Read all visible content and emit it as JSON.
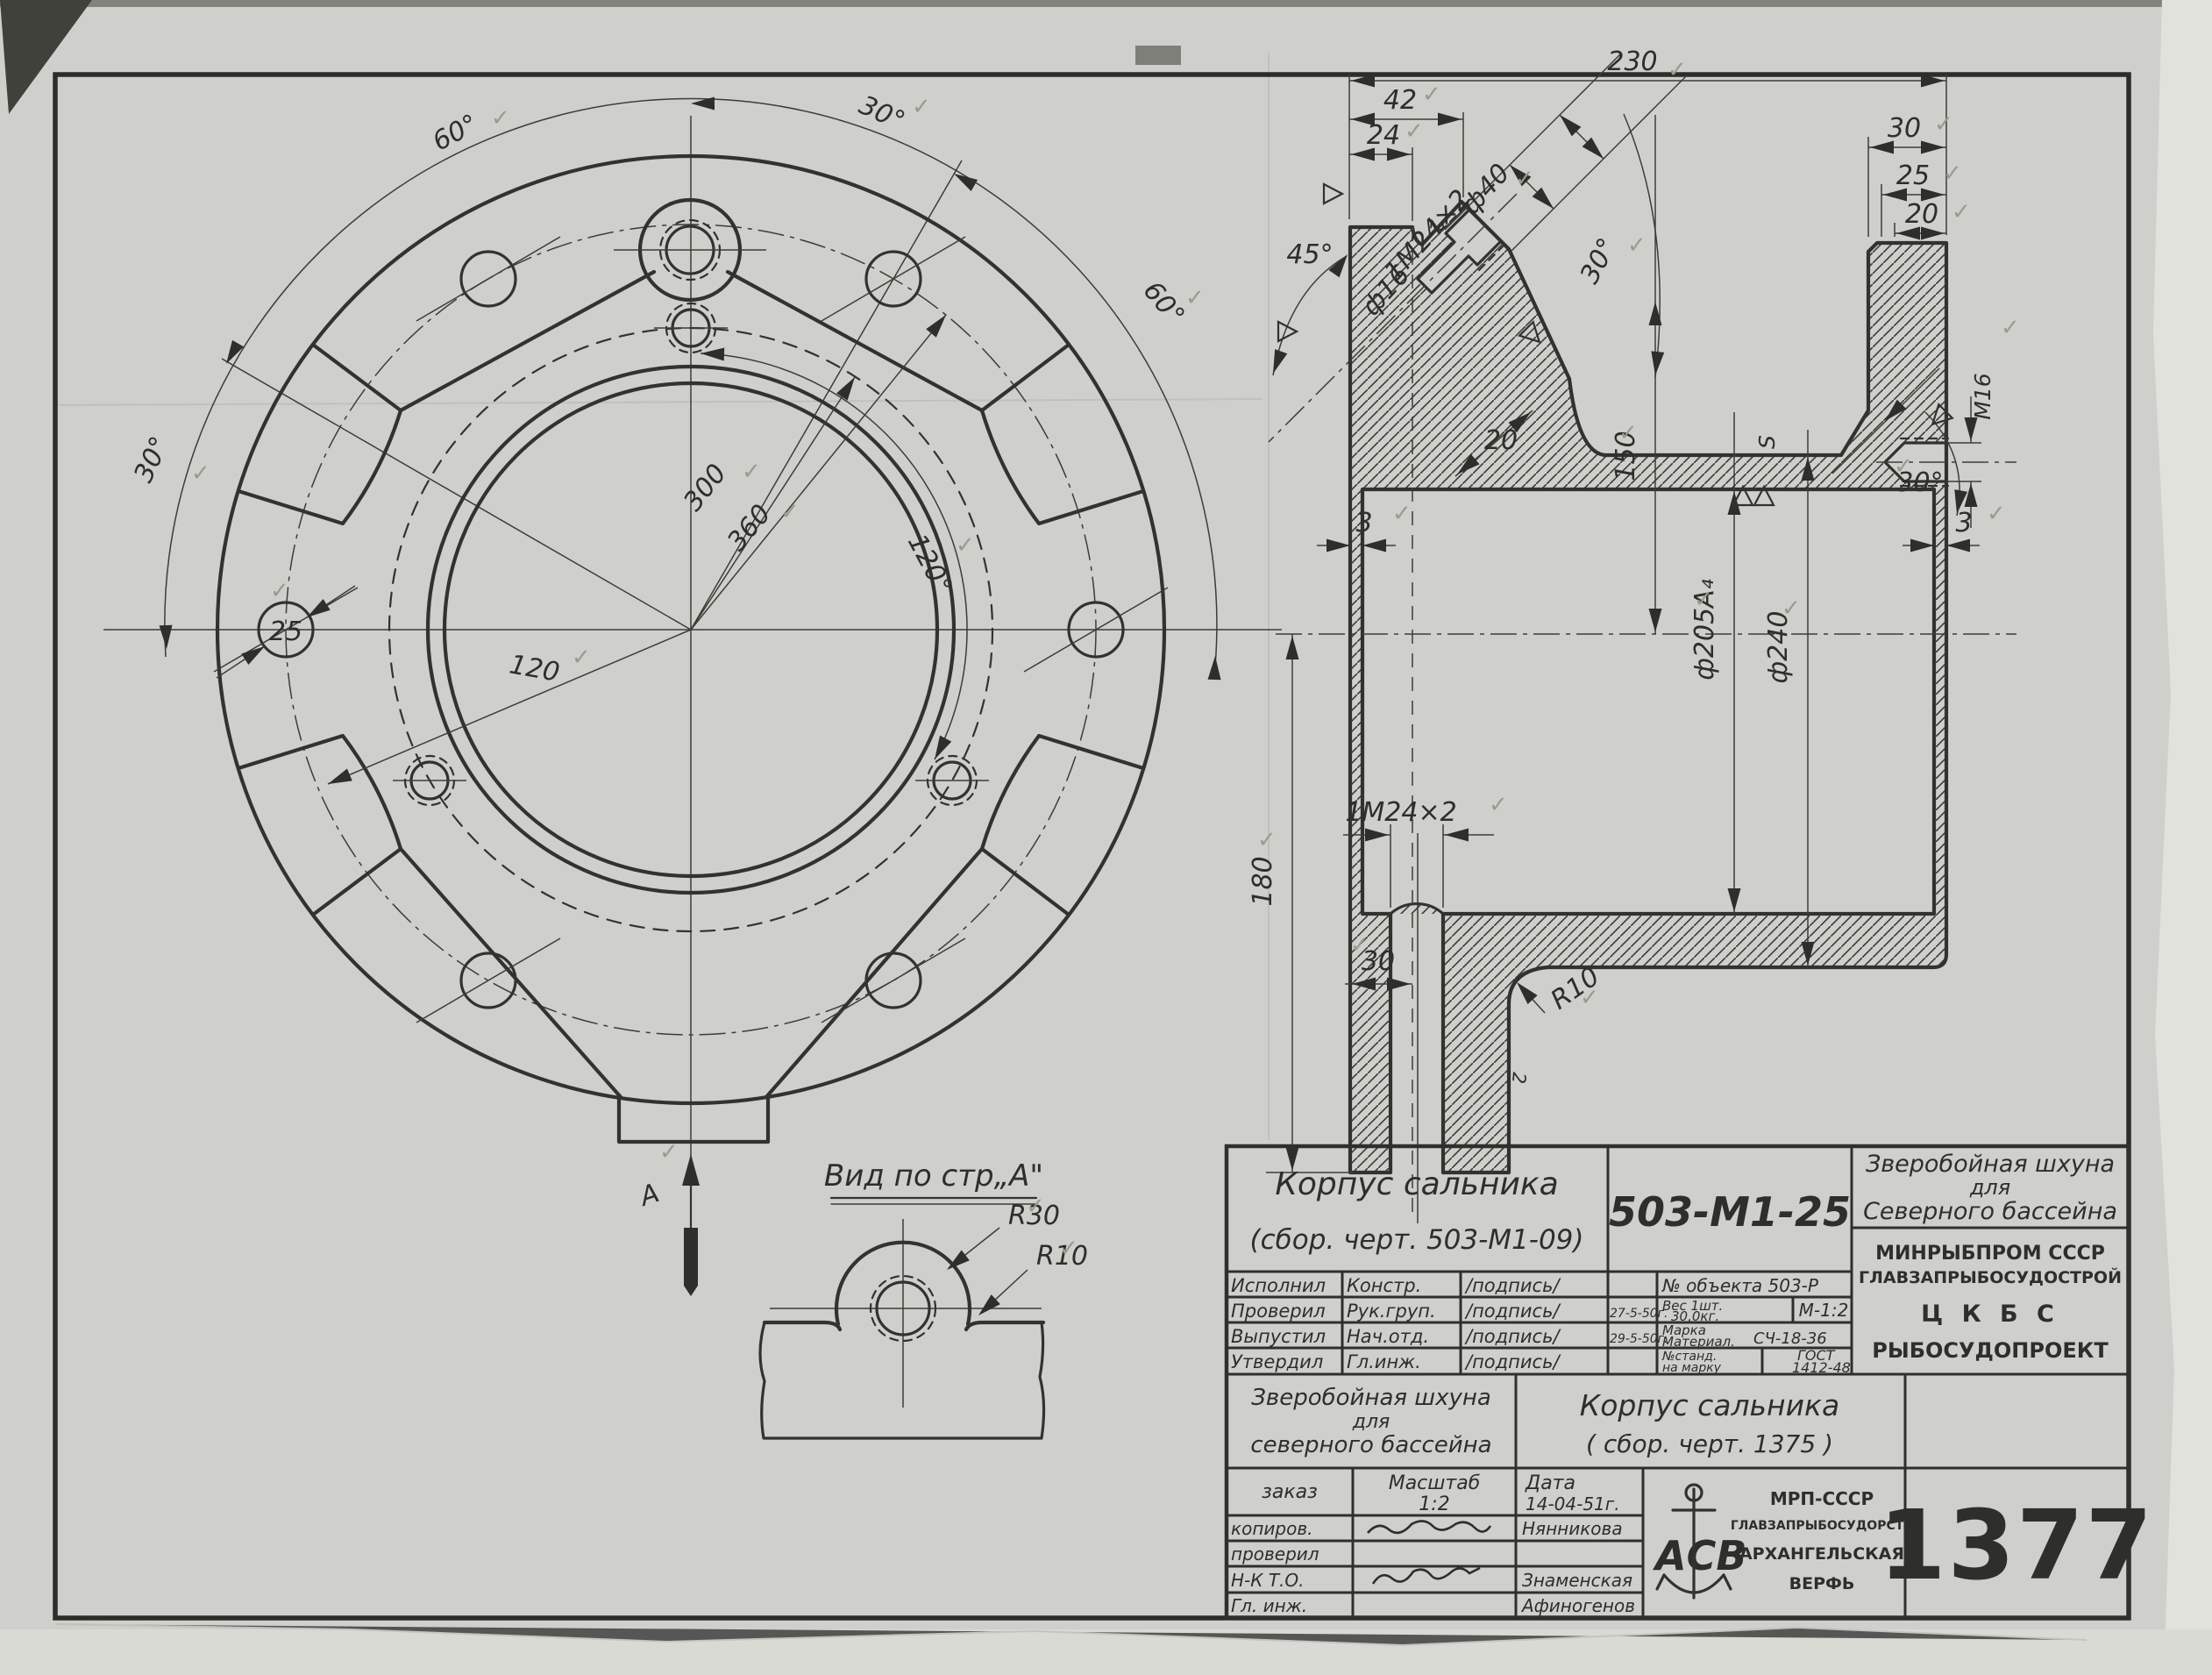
{
  "front_view": {
    "angle_top_left": "60°",
    "angle_top": "30°",
    "angle_right": "60°",
    "angle_left": "30°",
    "angle_bolt": "120°",
    "dim_bore": "300",
    "dim_bolt_circle": "360",
    "dim_left": "120",
    "hole_dia": "25",
    "view_arrow_label": "А"
  },
  "detail_view": {
    "title": "Вид по стр„А\"",
    "r_outer": "R30",
    "r_fillet": "R10"
  },
  "section_view": {
    "d230": "230",
    "d42": "42",
    "d24": "24",
    "r2_top": "2",
    "a45": "45°",
    "dia16": "ф16",
    "thr45": "1М24×2",
    "dia40": "ф40",
    "a30_top": "30°",
    "d20_slope": "20",
    "d30_right": "30",
    "d25_right": "25",
    "d20_right": "20",
    "m16": "М16",
    "a30_right": "30°",
    "w3_left": "3",
    "w3_right": "3",
    "d150": "150",
    "dia205": "ф205А₄",
    "dia240": "ф240",
    "s_mark": "S",
    "d180": "180",
    "thr_bottom": "1М24×2",
    "d30_bottom": "30",
    "r10": "R10",
    "r2_bottom": "2"
  },
  "title_block": {
    "part_title": "Корпус сальника",
    "part_subtitle": "(сбор. черт. 503-М1-09)",
    "doc_number": "503-М1-25",
    "ship1": "Зверобойная шхуна",
    "ship2": "для",
    "ship3": "Северного бассейна",
    "org1": "МИНРЫБПРОМ СССР",
    "org2": "ГЛАВЗАПРЫБОСУДОСТРОЙ",
    "org3": "Ц К Б С",
    "org4": "РЫБОСУДОПРОЕКТ",
    "rows": [
      {
        "role": "Исполнил",
        "who": "Констр.",
        "sig": "/подпись/",
        "date": ""
      },
      {
        "role": "Проверил",
        "who": "Рук.груп.",
        "sig": "/подпись/",
        "date": "27-5-50г."
      },
      {
        "role": "Выпустил",
        "who": "Нач.отд.",
        "sig": "/подпись/",
        "date": "29-5-50г."
      },
      {
        "role": "Утвердил",
        "who": "Гл.инж.",
        "sig": "/подпись/",
        "date": ""
      }
    ],
    "object_no": "№ объекта 503-Р",
    "weight1": "Вес 1шт.",
    "weight2": "30,0кг.",
    "scale_code": "М-1:2",
    "mat1": "Марка",
    "mat2": "Материал.",
    "mat_val": "СЧ-18-36",
    "std1": "№станд.",
    "std2": "на марку",
    "gost1": "ГОСТ",
    "gost2": "1412-48",
    "lower": {
      "ship1": "Зверобойная шхуна",
      "ship2": "для",
      "ship3": "северного бассейна",
      "part1": "Корпус сальника",
      "part2": "( сбор. черт. 1375 )",
      "zakaz": "заказ",
      "scale_lbl": "Масштаб",
      "scale_val": "1:2",
      "date_lbl": "Дата",
      "date_val": "14-04-51г.",
      "r1": "копиров.",
      "r2": "проверил",
      "r3": "Н-К Т.О.",
      "r4": "Гл. инж.",
      "n1": "Нянникова",
      "n3": "Знаменская",
      "n4": "Афиногенов",
      "org1": "МРП-СССР",
      "org2": "ГЛАВЗАПРЫБОСУДОРСТА",
      "org3": "АРХАНГЕЛЬСКАЯ",
      "org4": "ВЕРФЬ",
      "logo_letters": "АСВ",
      "stamp_number": "1377"
    }
  },
  "marks": {
    "check": "✓"
  }
}
